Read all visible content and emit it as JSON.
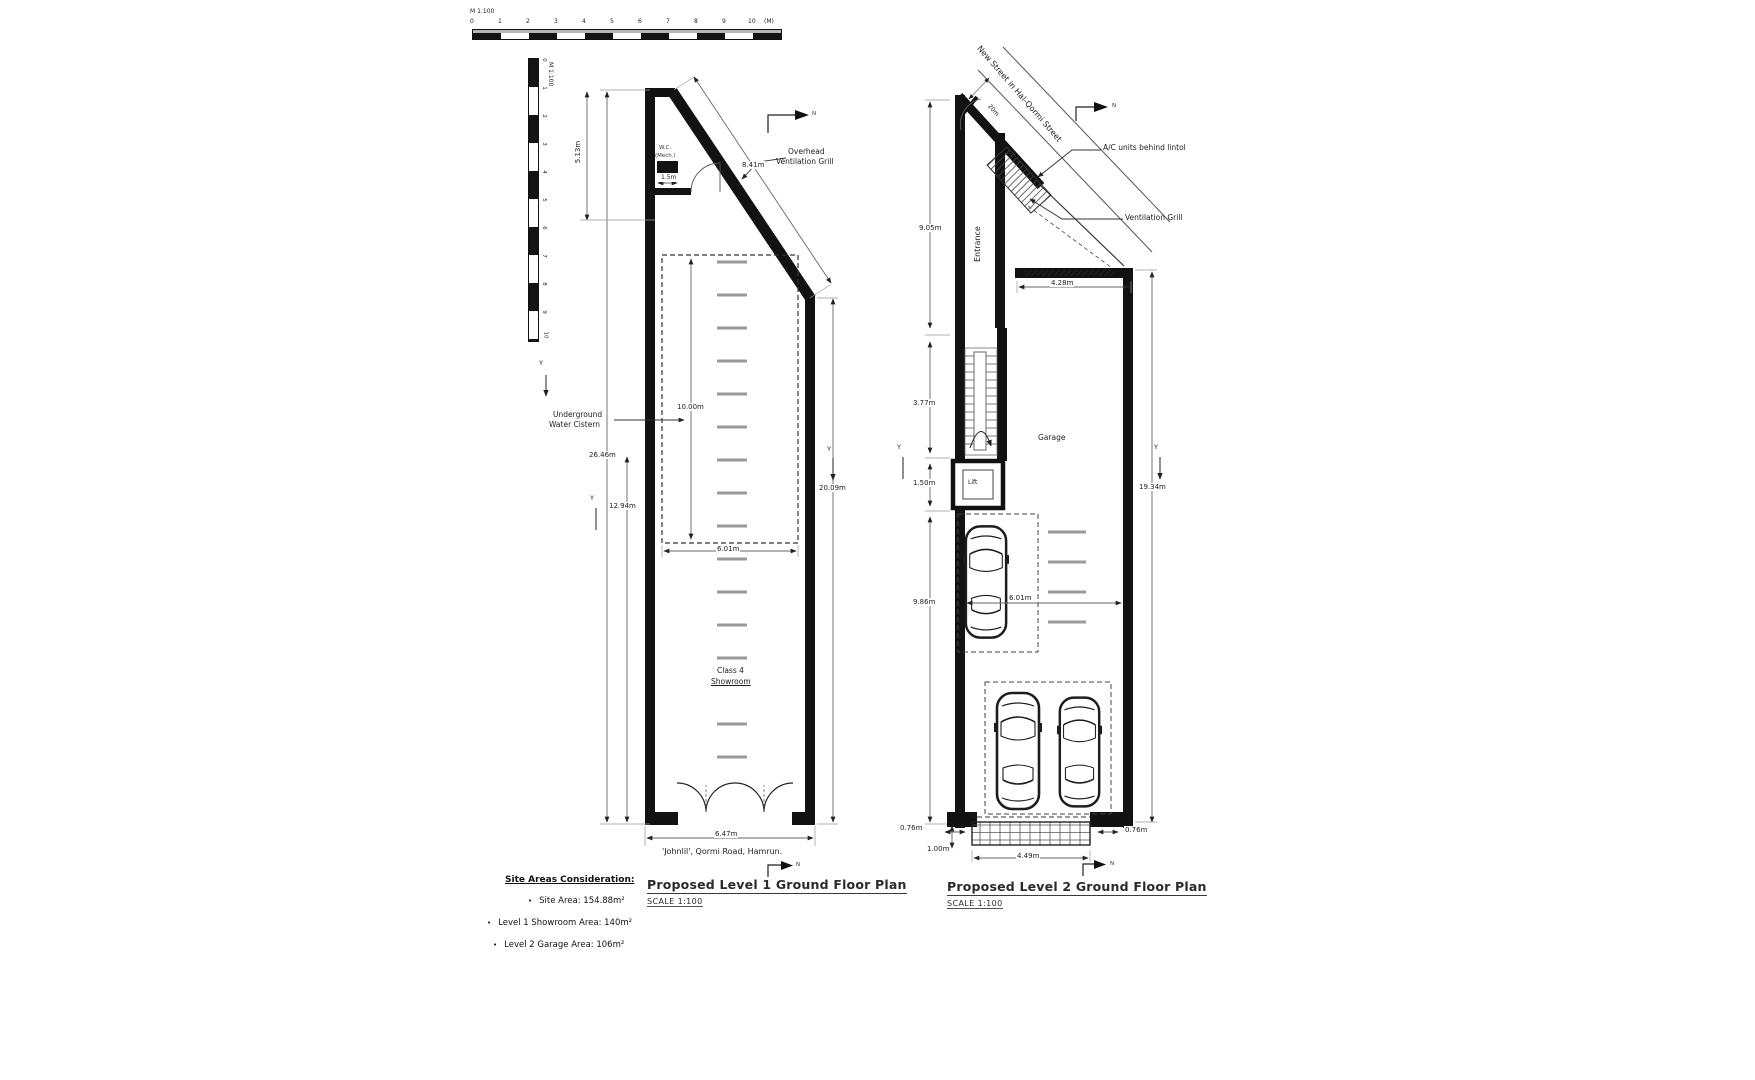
{
  "scalebar_h": {
    "title": "M 1:100",
    "unit": "(M)",
    "ticks": [
      "0",
      "1",
      "2",
      "3",
      "4",
      "5",
      "6",
      "7",
      "8",
      "9",
      "10"
    ]
  },
  "scalebar_v": {
    "title": "M 1:100",
    "ticks": [
      "0",
      "1",
      "2",
      "3",
      "4",
      "5",
      "6",
      "7",
      "8",
      "9",
      "10"
    ]
  },
  "section_marker": "Y",
  "north_letter": "N",
  "plan1": {
    "title": "Proposed Level 1 Ground Floor Plan",
    "scale_note": "SCALE 1:100",
    "address": "'Johnlil', Qormi Road, Hamrun.",
    "labels": {
      "wc": "W.C.",
      "wc_sub": "(Mech.)",
      "overhead_1": "Overhead",
      "overhead_2": "Ventilation Grill",
      "cistern_1": "Underground",
      "cistern_2": "Water Cistern",
      "room_1": "Class 4",
      "room_2": "Showroom"
    },
    "dims": {
      "top_left": "5.13m",
      "diagonal": "8.41m",
      "wc_width": "1.5m",
      "cistern_height": "10.00m",
      "overall_left": "26.46m",
      "lower_left": "12.94m",
      "cistern_width": "6.01m",
      "right_side": "20.09m",
      "overall_width": "6.47m"
    }
  },
  "plan2": {
    "title": "Proposed Level 2 Ground Floor Plan",
    "scale_note": "SCALE 1:100",
    "street": "New Street in Hal-Qormi Street",
    "labels": {
      "entrance": "Entrance",
      "garage": "Garage",
      "lift": "Lift",
      "ac": "A/C units behind lintol",
      "vent": "Ventilation Grill"
    },
    "dims": {
      "street_width": "20m",
      "entrance_height": "9.05m",
      "garage_opening": "4.28m",
      "stairs": "3.77m",
      "lift": "1.50m",
      "right_side": "19.34m",
      "lower_left": "9.86m",
      "garage_width": "6.01m",
      "offset_left": "0.76m",
      "offset_right": "0.76m",
      "ramp_depth": "1.00m",
      "ramp_width": "4.49m"
    }
  },
  "site_areas": {
    "heading": "Site Areas Consideration:",
    "bullet": "•",
    "items": [
      "Site Area: 154.88m²",
      "Level 1 Showroom Area: 140m²",
      "Level 2 Garage Area: 106m²"
    ]
  }
}
